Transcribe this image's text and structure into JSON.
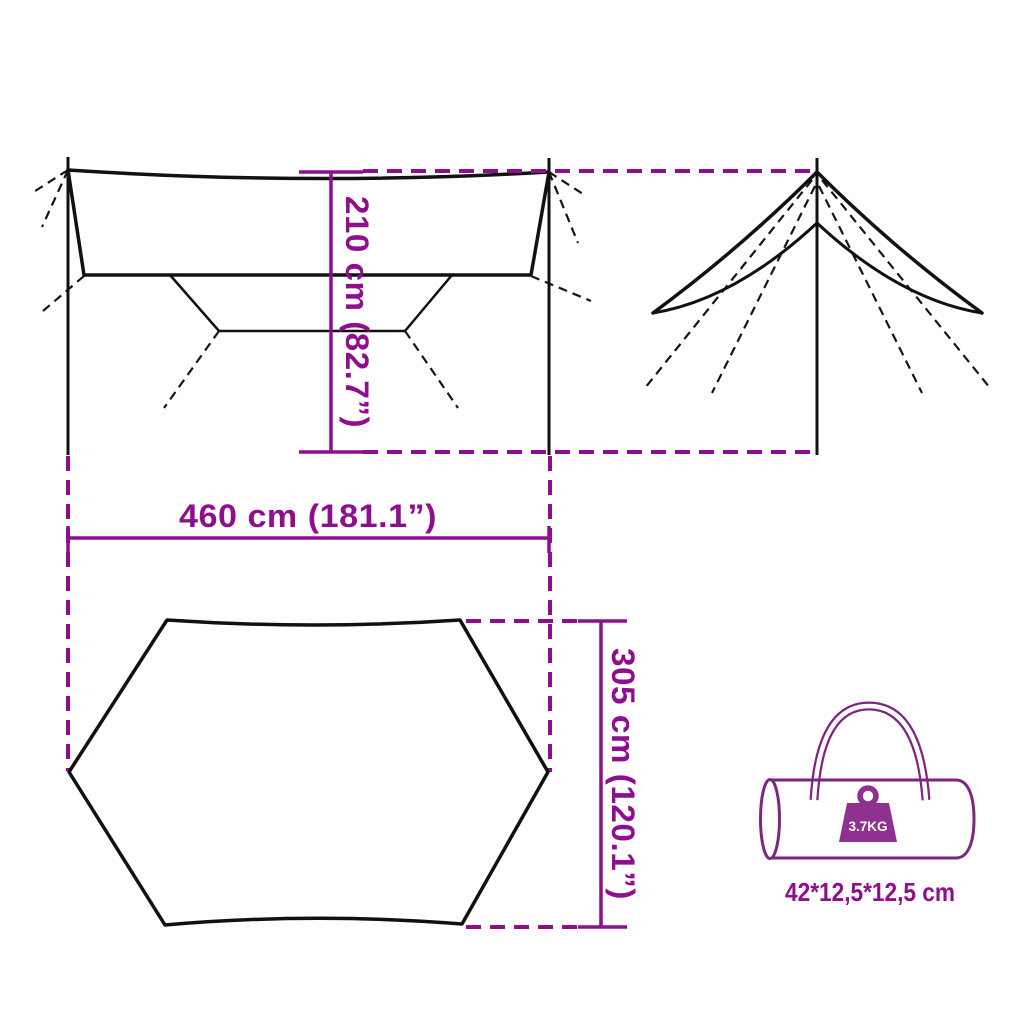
{
  "diagram": {
    "dimensions": {
      "height": {
        "label": "210 cm (82.7”)"
      },
      "width": {
        "label": "460 cm (181.1”)"
      },
      "depth": {
        "label": "305 cm (120.1”)"
      }
    },
    "carry_bag": {
      "weight": "3.7KG",
      "size": "42*12,5*12,5 cm"
    },
    "colors": {
      "dimension_magenta": "#8e0e8e",
      "outline_black": "#111111",
      "bag_purple": "#7d2680",
      "weight_badge_fill": "#8f3191",
      "background": "#ffffff"
    }
  }
}
